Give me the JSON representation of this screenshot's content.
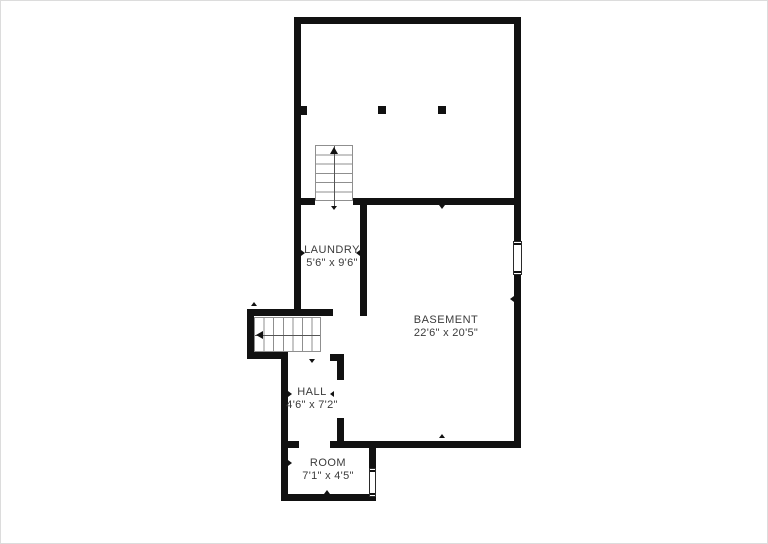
{
  "canvas": {
    "width": 768,
    "height": 544,
    "background": "#ffffff"
  },
  "floorplan": {
    "wall_color": "#111111",
    "label_color": "#3b3b3b",
    "rooms": [
      {
        "name": "LAUNDRY",
        "dimensions": "5'6\" x 9'6\""
      },
      {
        "name": "BASEMENT",
        "dimensions": "22'6\" x 20'5\""
      },
      {
        "name": "HALL",
        "dimensions": "4'6\" x 7'2\""
      },
      {
        "name": "ROOM",
        "dimensions": "7'1\" x 4'5\""
      }
    ]
  }
}
